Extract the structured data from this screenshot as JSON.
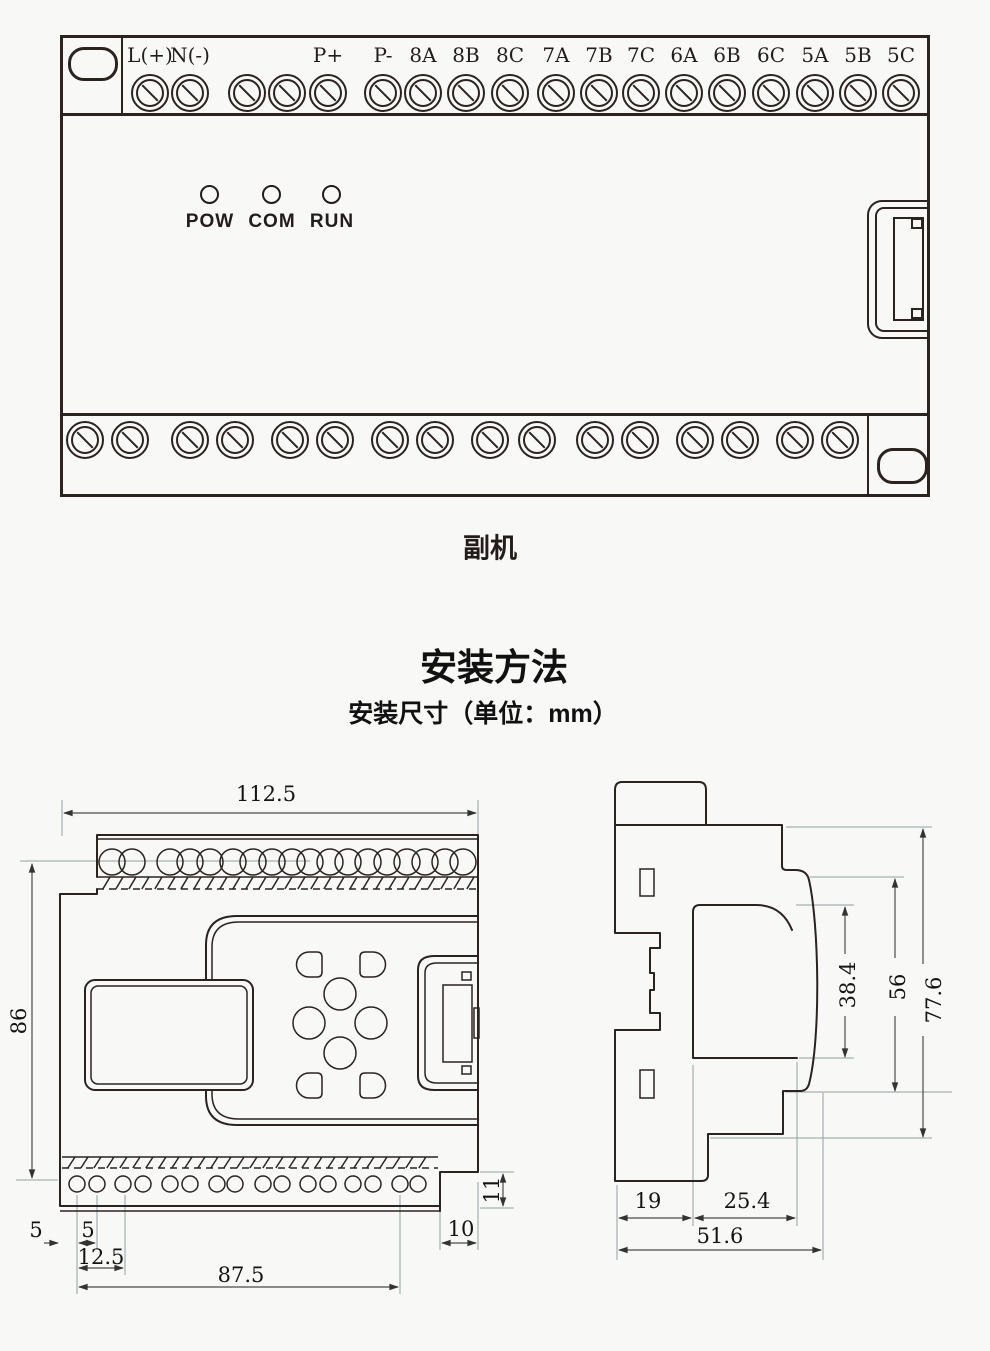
{
  "device": {
    "caption": "副机",
    "top_terminals": [
      {
        "x": 150,
        "label": "L(+)"
      },
      {
        "x": 190,
        "label": "N(-)"
      },
      {
        "x": 247,
        "label": ""
      },
      {
        "x": 287,
        "label": ""
      },
      {
        "x": 328,
        "label": "P+"
      },
      {
        "x": 383,
        "label": "P-"
      },
      {
        "x": 423,
        "label": "8A"
      },
      {
        "x": 466,
        "label": "8B"
      },
      {
        "x": 510,
        "label": "8C"
      },
      {
        "x": 556,
        "label": "7A"
      },
      {
        "x": 599,
        "label": "7B"
      },
      {
        "x": 641,
        "label": "7C"
      },
      {
        "x": 684,
        "label": "6A"
      },
      {
        "x": 727,
        "label": "6B"
      },
      {
        "x": 771,
        "label": "6C"
      },
      {
        "x": 815,
        "label": "5A"
      },
      {
        "x": 858,
        "label": "5B"
      },
      {
        "x": 901,
        "label": "5C"
      }
    ],
    "leds": [
      {
        "x": 210,
        "label": "POW"
      },
      {
        "x": 272,
        "label": "COM"
      },
      {
        "x": 332,
        "label": "RUN"
      }
    ],
    "bottom_screws": [
      {
        "x": 85
      },
      {
        "x": 130
      },
      {
        "x": 190
      },
      {
        "x": 235
      },
      {
        "x": 290
      },
      {
        "x": 335
      },
      {
        "x": 390
      },
      {
        "x": 435
      },
      {
        "x": 490
      },
      {
        "x": 537
      },
      {
        "x": 595
      },
      {
        "x": 640
      },
      {
        "x": 695
      },
      {
        "x": 740
      },
      {
        "x": 795
      },
      {
        "x": 840
      }
    ]
  },
  "section": {
    "title": "安装方法",
    "subtitle": "安装尺寸（单位：mm）"
  },
  "front_view": {
    "overall_width": "112.5",
    "overall_height": "86",
    "edge_to_hole": "5",
    "hole_pitch": "5",
    "hole_offset": "12.5",
    "hole_span": "87.5",
    "notch_width": "10",
    "notch_height": "11"
  },
  "side_view": {
    "panel_depth": "38.4",
    "body_depth": "56",
    "total_depth": "77.6",
    "back_width": "19",
    "mid_width": "25.4",
    "total_width": "51.6"
  }
}
